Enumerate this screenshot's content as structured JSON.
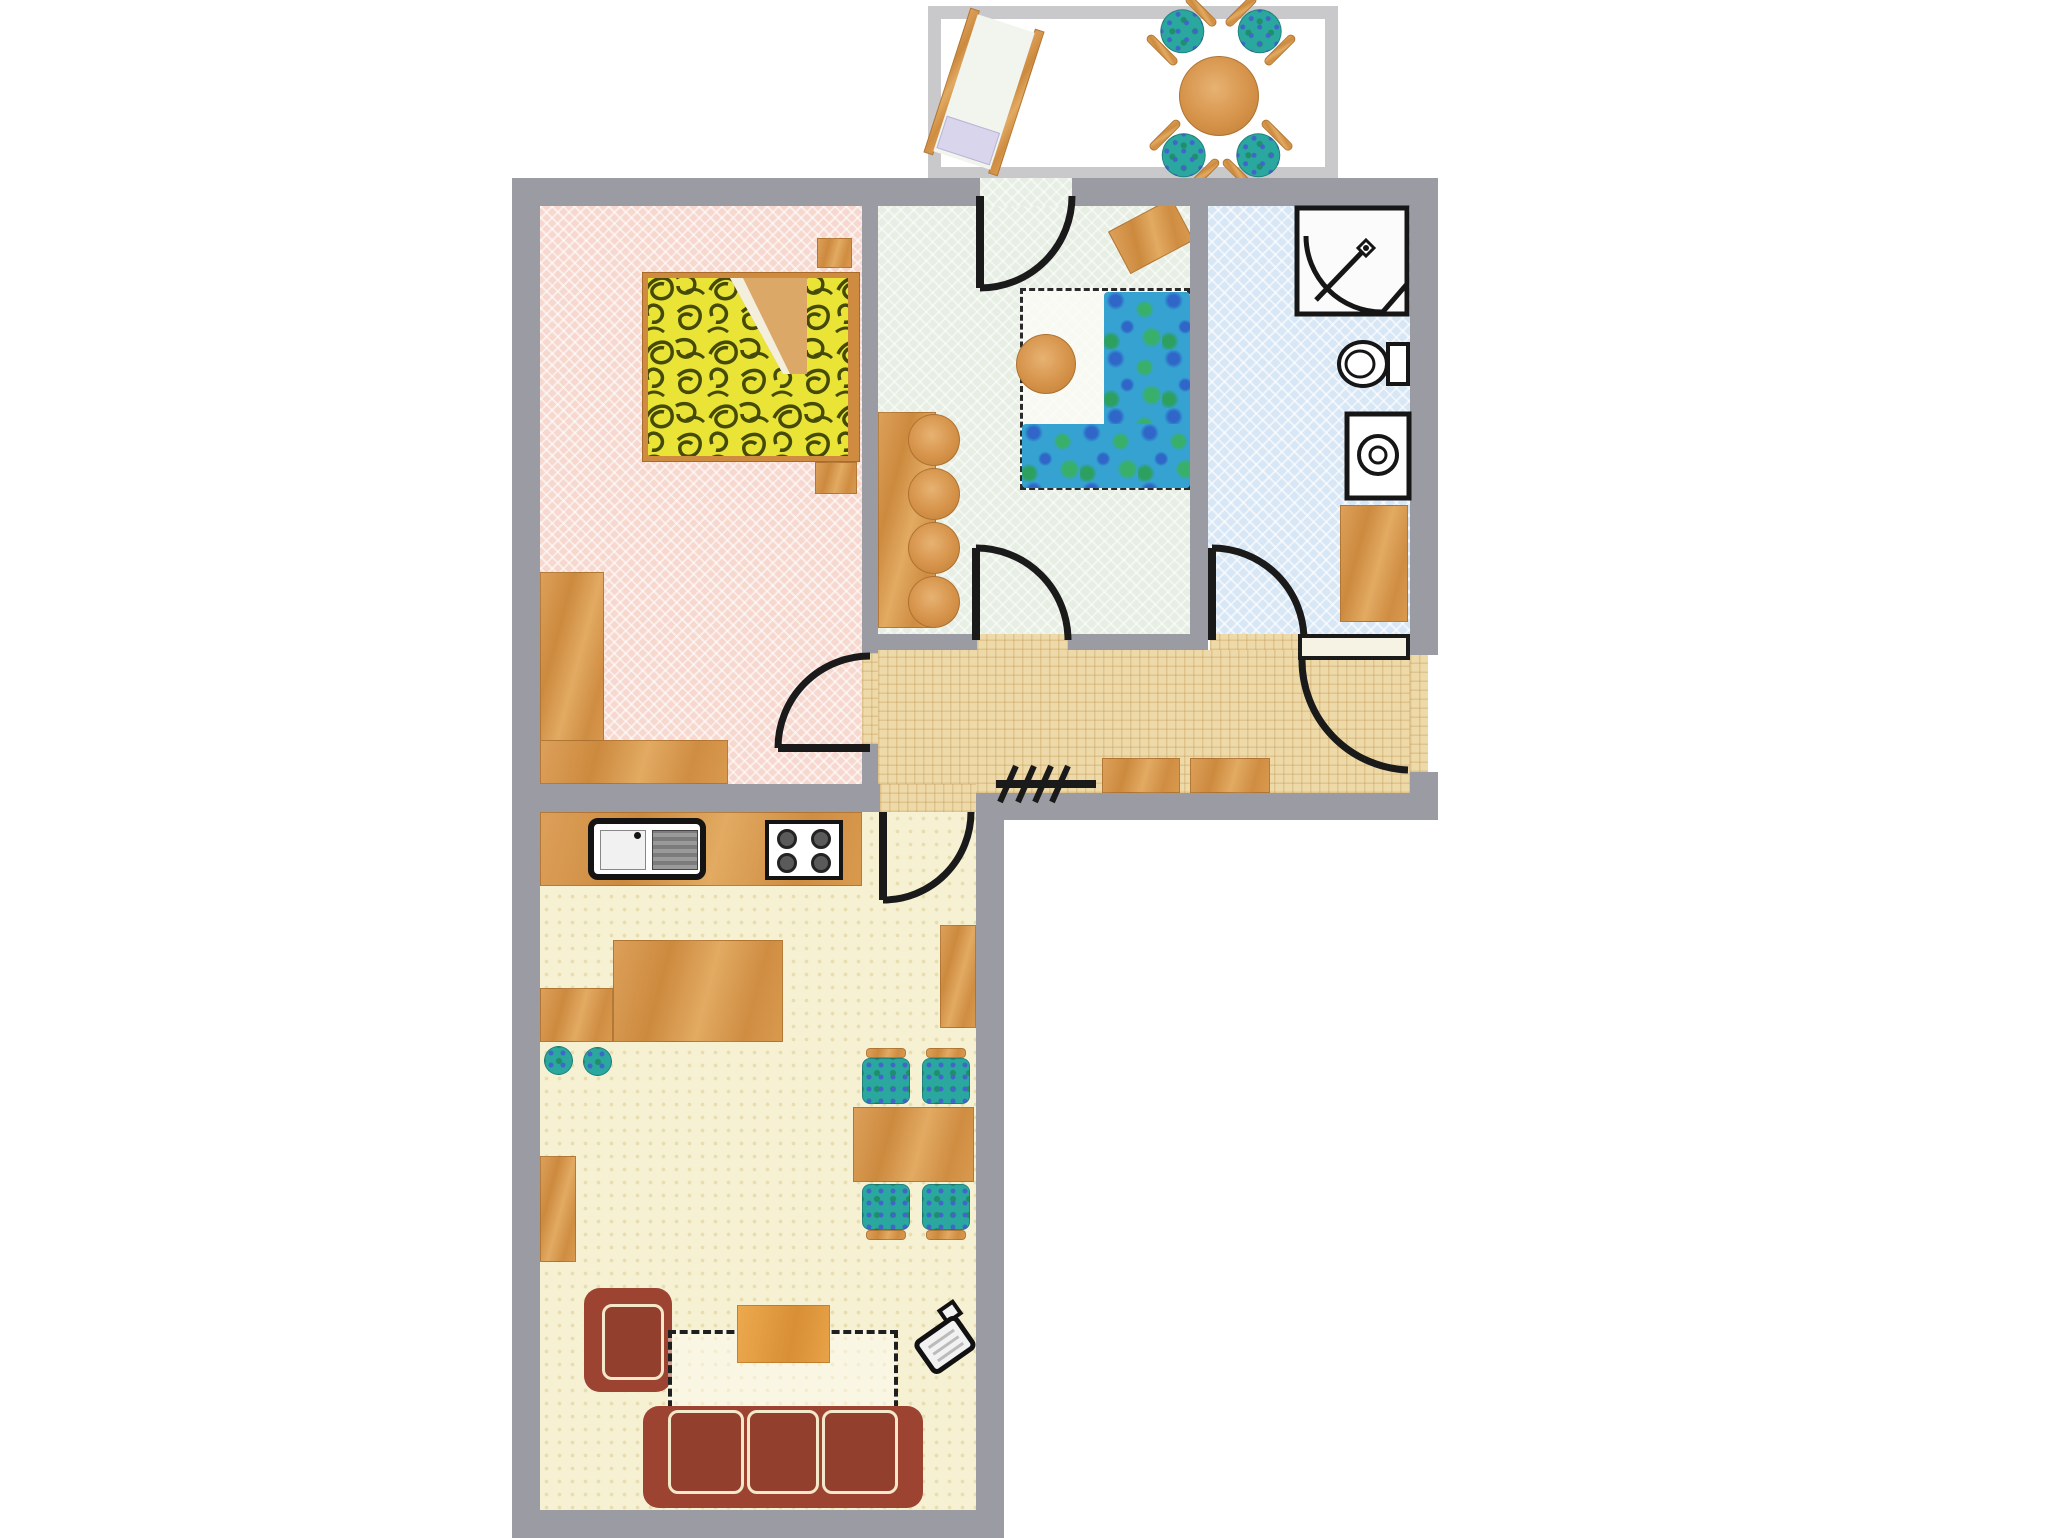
{
  "document": {
    "title": "Apartment floor plan",
    "type": "colored 2D floor plan, no text labels"
  },
  "colors": {
    "wall": "#9b9ba3",
    "balcony_border": "#c9c9cc",
    "bedroom_floor": "#f6d8cf",
    "kids_room_floor": "#e7eee3",
    "bathroom_floor": "#d7e7f5",
    "hallway_floor": "#eedaa9",
    "living_floor": "#f7f1d4",
    "wood": "#d69548",
    "sofa_red": "#9c4331",
    "coffee_table_orange": "#e09a42",
    "chair_teal": "#2aa79f",
    "duvet_yellow": "#e9e435",
    "line_black": "#1a1a1a"
  },
  "rooms": {
    "bedroom": {
      "name": "Bedroom (pink)",
      "furniture": [
        "double-bed with yellow patterned duvet",
        "nightstand",
        "nightstand",
        "wardrobe",
        "dresser"
      ]
    },
    "kids_room": {
      "name": "Study / kids room (green)",
      "furniture": [
        "wardrobe with scalloped doors",
        "tilted desk",
        "corner sofa (marbled blue-green)",
        "round stool",
        "dashed play/desk area"
      ]
    },
    "bathroom": {
      "name": "Bathroom (blue)",
      "furniture": [
        "corner shower",
        "toilet",
        "washing machine",
        "cabinet"
      ]
    },
    "hallway": {
      "name": "Hallway (tan)",
      "furniture": [
        "coat rack",
        "cabinet",
        "cabinet"
      ]
    },
    "living": {
      "name": "Living room with open kitchen (cream)",
      "furniture": [
        "kitchen counter",
        "sink unit",
        "stove with 4 burners",
        "kitchen island",
        "stool",
        "stool",
        "sideboard",
        "dining table",
        "dining chair",
        "dining chair",
        "dining chair",
        "dining chair",
        "armchair",
        "rug (dashed)",
        "coffee table",
        "three-seat sofa",
        "tv",
        "wall shelf"
      ]
    },
    "balcony": {
      "name": "Balcony",
      "furniture": [
        "sun lounger with pillow",
        "round table",
        "chair",
        "chair",
        "chair",
        "chair"
      ]
    }
  },
  "doors": [
    "balcony door (kids room, top wall)",
    "bedroom door (to hallway)",
    "kids room door (to hallway)",
    "bathroom door (to hallway)",
    "living room door (to hallway)",
    "entrance door (right wall of hallway)"
  ]
}
